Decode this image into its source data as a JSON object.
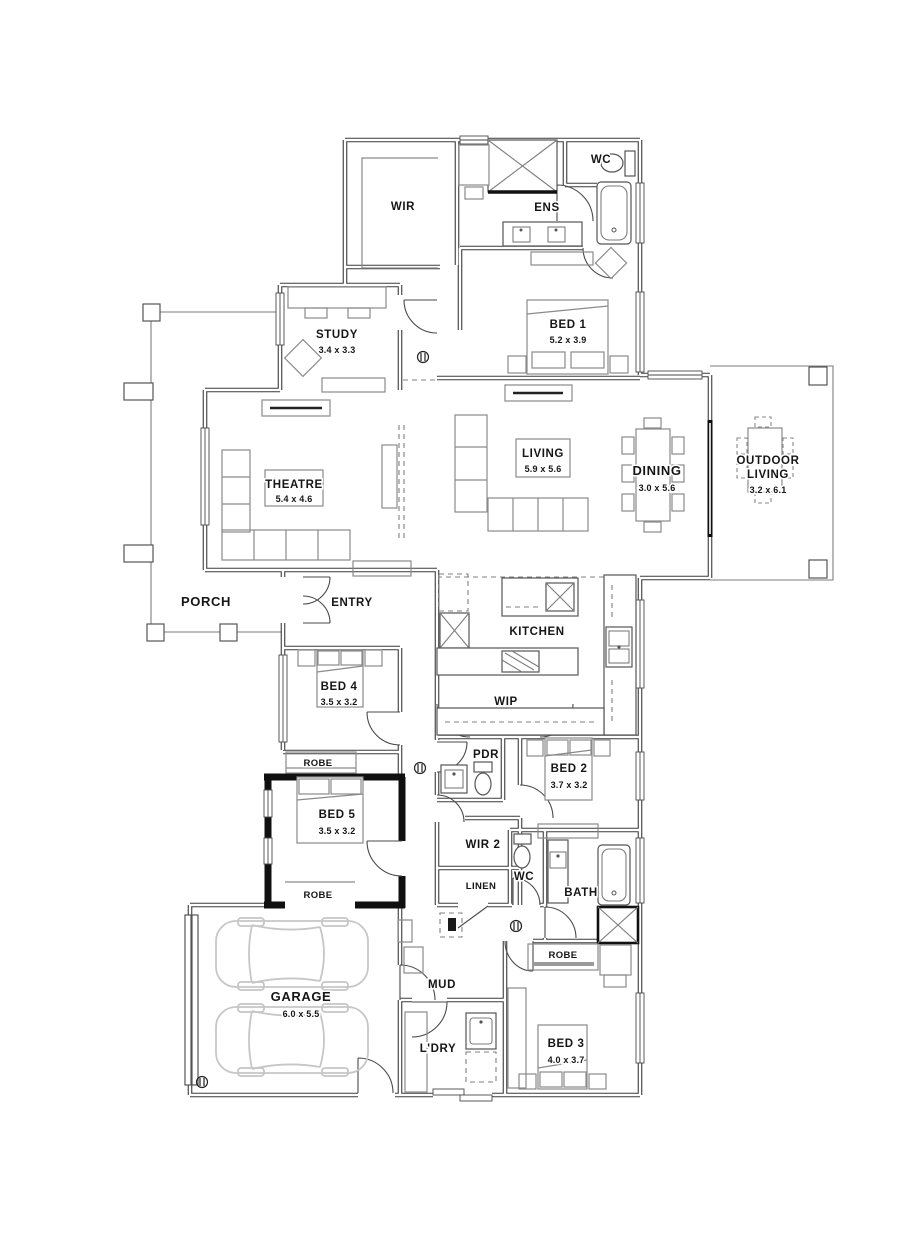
{
  "plan": {
    "type": "residential-floor-plan",
    "colors": {
      "wall": "#3a3a3a",
      "feature_wall": "#101010",
      "furniture": "#8a8a8a",
      "car": "#c6c6c6",
      "background": "#ffffff"
    }
  },
  "rooms": {
    "wir": {
      "label": "WIR"
    },
    "wc_ens": {
      "label": "WC"
    },
    "ens": {
      "label": "ENS"
    },
    "bed1": {
      "label": "BED 1",
      "dim": "5.2 x 3.9"
    },
    "study": {
      "label": "STUDY",
      "dim": "3.4 x 3.3"
    },
    "theatre": {
      "label": "THEATRE",
      "dim": "5.4 x 4.6"
    },
    "living": {
      "label": "LIVING",
      "dim": "5.9 x 5.6"
    },
    "dining": {
      "label": "DINING",
      "dim": "3.0 x 5.6"
    },
    "outdoor": {
      "line1": "OUTDOOR",
      "line2": "LIVING",
      "dim": "3.2 x 6.1"
    },
    "porch": {
      "label": "PORCH"
    },
    "entry": {
      "label": "ENTRY"
    },
    "kitchen": {
      "label": "KITCHEN"
    },
    "wip": {
      "label": "WIP"
    },
    "bed4": {
      "label": "BED 4",
      "dim": "3.5 x 3.2"
    },
    "robe4": {
      "label": "ROBE"
    },
    "bed5": {
      "label": "BED 5",
      "dim": "3.5 x 3.2"
    },
    "robe5": {
      "label": "ROBE"
    },
    "pdr": {
      "label": "PDR"
    },
    "bed2": {
      "label": "BED 2",
      "dim": "3.7 x 3.2"
    },
    "wir2": {
      "label": "WIR 2"
    },
    "linen": {
      "label": "LINEN"
    },
    "wc2": {
      "label": "WC"
    },
    "bath": {
      "label": "BATH"
    },
    "garage": {
      "label": "GARAGE",
      "dim": "6.0 x 5.5"
    },
    "mud": {
      "label": "MUD"
    },
    "ldry": {
      "label": "L'DRY"
    },
    "bed3": {
      "label": "BED 3",
      "dim": "4.0 x 3.7"
    },
    "robe3": {
      "label": "ROBE"
    }
  }
}
